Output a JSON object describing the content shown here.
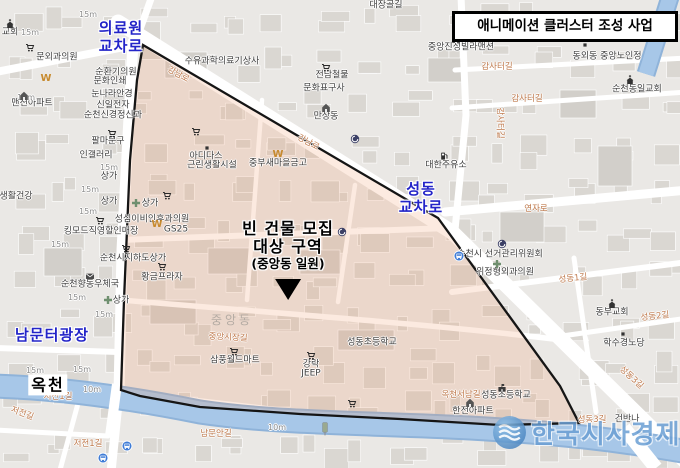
{
  "title_box": {
    "label": "애니메이션 클러스터 조성 사업"
  },
  "annotations": {
    "medical_center_crossing": {
      "line1": "의료원",
      "line2": "교차로"
    },
    "seongdong_crossing": {
      "line1": "성동",
      "line2": "교차로"
    },
    "nammunteo_plaza": {
      "label": "남문터광장"
    },
    "okcheon_stream": {
      "label": "옥천"
    },
    "target_area": {
      "line1": "빈 건물 모집",
      "line2": "대상 구역",
      "line3": "(중앙동 일원)"
    }
  },
  "watermark": {
    "text": "한국시사경제"
  },
  "map": {
    "poi_labels": [
      {
        "text": "교회",
        "x": 10,
        "y": 33
      },
      {
        "text": "문외과의원",
        "x": 57,
        "y": 58
      },
      {
        "text": "맨션아파트",
        "x": 32,
        "y": 104
      },
      {
        "text": "순환기의원",
        "x": 116,
        "y": 73
      },
      {
        "text": "문화인쇄",
        "x": 110,
        "y": 82
      },
      {
        "text": "눈나라안경",
        "x": 112,
        "y": 95
      },
      {
        "text": "신일전자",
        "x": 113,
        "y": 106
      },
      {
        "text": "순천신경정신과",
        "x": 113,
        "y": 116
      },
      {
        "text": "수유과학의료기상사",
        "x": 222,
        "y": 62
      },
      {
        "text": "전남철물",
        "x": 332,
        "y": 76
      },
      {
        "text": "문화표구사",
        "x": 324,
        "y": 89
      },
      {
        "text": "만상동",
        "x": 326,
        "y": 117
      },
      {
        "text": "중앙진성빌라맨션",
        "x": 461,
        "y": 48
      },
      {
        "text": "동외동 중앙노인정",
        "x": 607,
        "y": 57
      },
      {
        "text": "순천동일교회",
        "x": 637,
        "y": 90
      },
      {
        "text": "대한주유소",
        "x": 446,
        "y": 166
      },
      {
        "text": "순천시 선거관리위원회",
        "x": 500,
        "y": 255
      },
      {
        "text": "위정형외과의원",
        "x": 505,
        "y": 273
      },
      {
        "text": "동부교회",
        "x": 612,
        "y": 313
      },
      {
        "text": "학수경노당",
        "x": 624,
        "y": 344
      },
      {
        "text": "성동초등학교",
        "x": 372,
        "y": 343
      },
      {
        "text": "성동초등학교",
        "x": 506,
        "y": 396
      },
      {
        "text": "한전아파트",
        "x": 473,
        "y": 412
      },
      {
        "text": "삼풍월드마트",
        "x": 235,
        "y": 361
      },
      {
        "text": "강락",
        "x": 311,
        "y": 365
      },
      {
        "text": "JEEP",
        "x": 311,
        "y": 374
      },
      {
        "text": "아디다스",
        "x": 206,
        "y": 157
      },
      {
        "text": "근린생활시설",
        "x": 212,
        "y": 166
      },
      {
        "text": "중부새마을금고",
        "x": 278,
        "y": 164
      },
      {
        "text": "성심이비인후과의원",
        "x": 152,
        "y": 220
      },
      {
        "text": "GS25",
        "x": 176,
        "y": 230
      },
      {
        "text": "킹모드직영할인매장",
        "x": 101,
        "y": 232
      },
      {
        "text": "순천시지하도상가",
        "x": 133,
        "y": 259
      },
      {
        "text": "순천향동우체국",
        "x": 90,
        "y": 285
      },
      {
        "text": "황금프라자",
        "x": 162,
        "y": 278
      },
      {
        "text": "팔마문구",
        "x": 108,
        "y": 142
      },
      {
        "text": "인갤러리",
        "x": 96,
        "y": 156
      },
      {
        "text": "상가",
        "x": 109,
        "y": 177
      },
      {
        "text": "상가",
        "x": 109,
        "y": 202
      },
      {
        "text": "상가",
        "x": 150,
        "y": 204
      },
      {
        "text": "상가",
        "x": 121,
        "y": 301
      },
      {
        "text": "생활건강",
        "x": 16,
        "y": 197
      },
      {
        "text": "건반나",
        "x": 627,
        "y": 420
      },
      {
        "text": "대장골길",
        "x": 386,
        "y": 6
      }
    ],
    "road_labels": [
      {
        "text": "강남로",
        "x": 178,
        "y": 75,
        "rot": 28
      },
      {
        "text": "강남로",
        "x": 308,
        "y": 143,
        "rot": 28
      },
      {
        "text": "감사터길",
        "x": 497,
        "y": 67
      },
      {
        "text": "감사터길",
        "x": 527,
        "y": 99
      },
      {
        "text": "감사터길",
        "x": 499,
        "y": 123,
        "rot": 90
      },
      {
        "text": "연자로",
        "x": 536,
        "y": 209
      },
      {
        "text": "성동1길",
        "x": 573,
        "y": 279,
        "rot": -6
      },
      {
        "text": "성동2길",
        "x": 655,
        "y": 317,
        "rot": -6
      },
      {
        "text": "성동3길",
        "x": 631,
        "y": 378,
        "rot": 42
      },
      {
        "text": "성동3길",
        "x": 592,
        "y": 420
      },
      {
        "text": "옥천서남길",
        "x": 461,
        "y": 395
      },
      {
        "text": "남문안길",
        "x": 216,
        "y": 434
      },
      {
        "text": "중앙시장길",
        "x": 228,
        "y": 338,
        "rot": 3
      },
      {
        "text": "저전1길",
        "x": 58,
        "y": 397
      },
      {
        "text": "저전길",
        "x": 22,
        "y": 414,
        "rot": 20
      },
      {
        "text": "저전1길",
        "x": 88,
        "y": 444
      }
    ],
    "width_labels": [
      {
        "text": "15m",
        "x": 88,
        "y": 15
      },
      {
        "text": "15m",
        "x": 30,
        "y": 33
      },
      {
        "text": "15m",
        "x": 26,
        "y": 98
      },
      {
        "text": "15m",
        "x": 109,
        "y": 168
      },
      {
        "text": "15m",
        "x": 90,
        "y": 190
      },
      {
        "text": "15m",
        "x": 88,
        "y": 212
      },
      {
        "text": "15m",
        "x": 60,
        "y": 245
      },
      {
        "text": "15m",
        "x": 77,
        "y": 298
      },
      {
        "text": "15m",
        "x": 104,
        "y": 315
      },
      {
        "text": "15m",
        "x": 35,
        "y": 371
      },
      {
        "text": "15m",
        "x": 82,
        "y": 370
      },
      {
        "text": "10m",
        "x": 92,
        "y": 390
      },
      {
        "text": "10m",
        "x": 277,
        "y": 428
      }
    ],
    "district_labels": [
      {
        "text": "중앙동",
        "x": 232,
        "y": 320
      }
    ],
    "icons": [
      {
        "name": "cart-icon",
        "x": 30,
        "y": 48
      },
      {
        "name": "cart-icon",
        "x": 326,
        "y": 68
      },
      {
        "name": "cart-icon",
        "x": 112,
        "y": 134
      },
      {
        "name": "cart-icon",
        "x": 196,
        "y": 132
      },
      {
        "name": "cart-icon",
        "x": 167,
        "y": 196
      },
      {
        "name": "cart-icon",
        "x": 100,
        "y": 221
      },
      {
        "name": "cart-icon",
        "x": 126,
        "y": 249
      },
      {
        "name": "cart-icon",
        "x": 162,
        "y": 267
      },
      {
        "name": "cart-icon",
        "x": 234,
        "y": 352
      },
      {
        "name": "cart-icon",
        "x": 311,
        "y": 356
      },
      {
        "name": "cart-icon",
        "x": 352,
        "y": 404
      },
      {
        "name": "church-icon",
        "x": 10,
        "y": 24
      },
      {
        "name": "church-icon",
        "x": 630,
        "y": 80
      },
      {
        "name": "church-icon",
        "x": 612,
        "y": 304
      },
      {
        "name": "saemaeul-w-icon",
        "x": 46,
        "y": 77
      },
      {
        "name": "saemaeul-w-icon",
        "x": 157,
        "y": 223
      },
      {
        "name": "saemaeul-w-icon",
        "x": 278,
        "y": 153
      },
      {
        "name": "bus-stop-icon",
        "x": 459,
        "y": 256
      },
      {
        "name": "bus-stop-icon",
        "x": 103,
        "y": 458
      },
      {
        "name": "bus-stop-icon",
        "x": 127,
        "y": 446
      },
      {
        "name": "gas-station-icon",
        "x": 444,
        "y": 156
      },
      {
        "name": "school-icon",
        "x": 502,
        "y": 388
      },
      {
        "name": "post-office-icon",
        "x": 90,
        "y": 276
      },
      {
        "name": "hospital-cross-icon",
        "x": 497,
        "y": 264
      },
      {
        "name": "hospital-cross-icon",
        "x": 136,
        "y": 203
      },
      {
        "name": "hospital-cross-icon",
        "x": 108,
        "y": 300
      },
      {
        "name": "house-icon",
        "x": 24,
        "y": 96
      },
      {
        "name": "house-icon",
        "x": 456,
        "y": 39
      },
      {
        "name": "house-icon",
        "x": 326,
        "y": 108
      },
      {
        "name": "house-icon",
        "x": 470,
        "y": 403
      },
      {
        "name": "gov-building-icon",
        "x": 355,
        "y": 139
      },
      {
        "name": "gov-building-icon",
        "x": 342,
        "y": 232
      },
      {
        "name": "gov-building-icon",
        "x": 502,
        "y": 244
      },
      {
        "name": "dot-marker-icon",
        "x": 585,
        "y": 45
      },
      {
        "name": "dot-marker-icon",
        "x": 623,
        "y": 334
      },
      {
        "name": "dot-marker-icon",
        "x": 207,
        "y": 148
      },
      {
        "name": "bridge-sign-icon",
        "x": 325,
        "y": 429
      }
    ]
  },
  "colors": {
    "annotation_blue": "#2324c8",
    "boundary_black": "#151515",
    "target_area_fill": "#f29464",
    "water_blue": "#a3c4e6",
    "road_white": "#ffffff",
    "map_background": "#eae8e5",
    "watermark_blue": "#6b9fd4",
    "title_text": "#000000"
  }
}
